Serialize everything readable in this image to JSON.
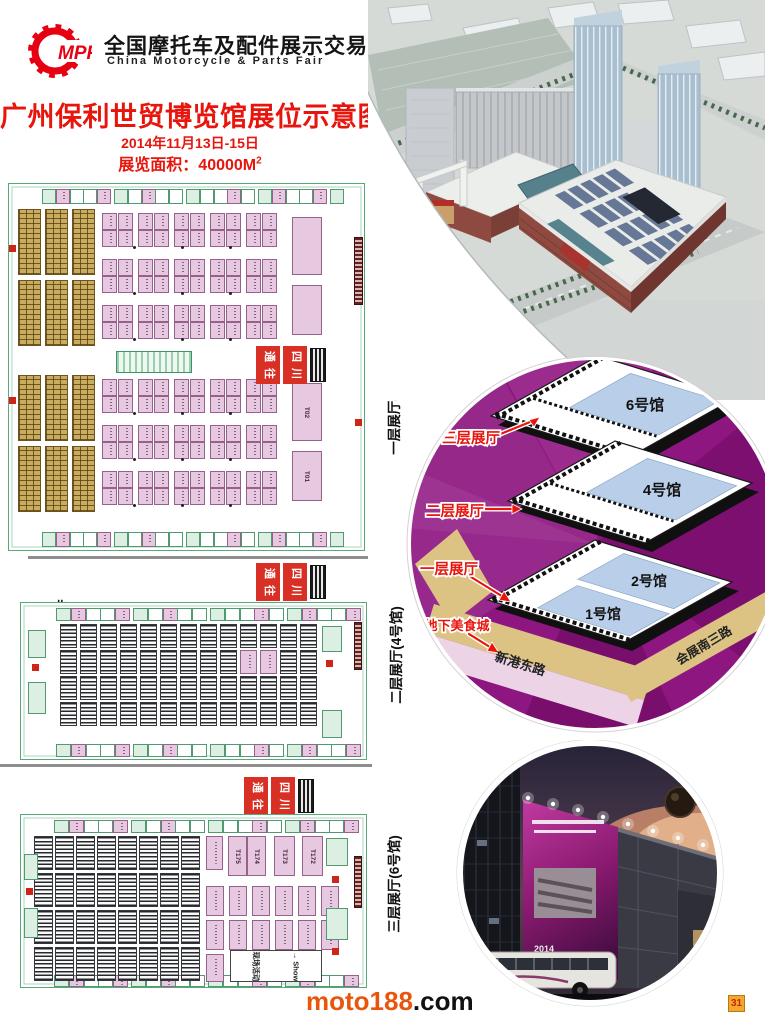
{
  "header": {
    "logo_text": "MPF",
    "org_cn": "全国摩托车及配件展示交易会",
    "org_en": "China Motorcycle & Parts Fair",
    "title": "广州保利世贸博览馆展位示意图",
    "date": "2014年11月13日-15日",
    "area_label": "展览面积：40000M",
    "area_sup": "2"
  },
  "plans": [
    {
      "label": "一层展厅(1号馆、2号馆)",
      "escalator_sign": [
        "通往",
        "四川"
      ],
      "large_booth_labels": [
        "T02",
        "T01"
      ],
      "grid": {
        "sections": 2,
        "gold_cols": 3,
        "gold_bands": 2,
        "pink_cols": 10,
        "pink_row_pairs": 3,
        "strip_booths": 21
      }
    },
    {
      "label": "二层展厅(4号馆)",
      "north_label": "北",
      "escalator_sign": [
        "通往",
        "四川"
      ],
      "grid": {
        "stripe_cols": 13,
        "stripe_bands": 4,
        "pink_cells": 2,
        "strip_booths": 20
      }
    },
    {
      "label": "三层展厅(6号馆)",
      "escalator_sign": [
        "通往",
        "四川"
      ],
      "large_booth_labels": [
        "T175",
        "T174",
        "T173",
        "T172"
      ],
      "activity_cn": "现场活动",
      "activity_en": "Show",
      "grid": {
        "stripe_cols": 8,
        "stripe_bands": 4,
        "pink_cols": 6,
        "pink_bands": 2,
        "strip_booths": 20
      }
    }
  ],
  "stack_diagram": {
    "halls": {
      "h6": "6号馆",
      "h4": "4号馆",
      "h2": "2号馆",
      "h1": "1号馆"
    },
    "floor_labels": {
      "f3": "三层展厅",
      "f2": "二层展厅",
      "f1": "一层展厅",
      "basement": "地下美食城"
    },
    "roads": {
      "south": "新港东路",
      "east": "会展南三路"
    }
  },
  "night_photo": {
    "billboard_text": "2014"
  },
  "footer": {
    "site_name": "moto188",
    "site_tld": ".com",
    "page_number": "31"
  },
  "colors": {
    "accent_red": "#e8150d",
    "logo_red": "#e60012",
    "booth_pink": "#e6c9e1",
    "plan_green": "#58a878",
    "circle_purple": "#8d1680",
    "road_tan": "#dcc383",
    "floor_blue": "#b9cfe9"
  }
}
